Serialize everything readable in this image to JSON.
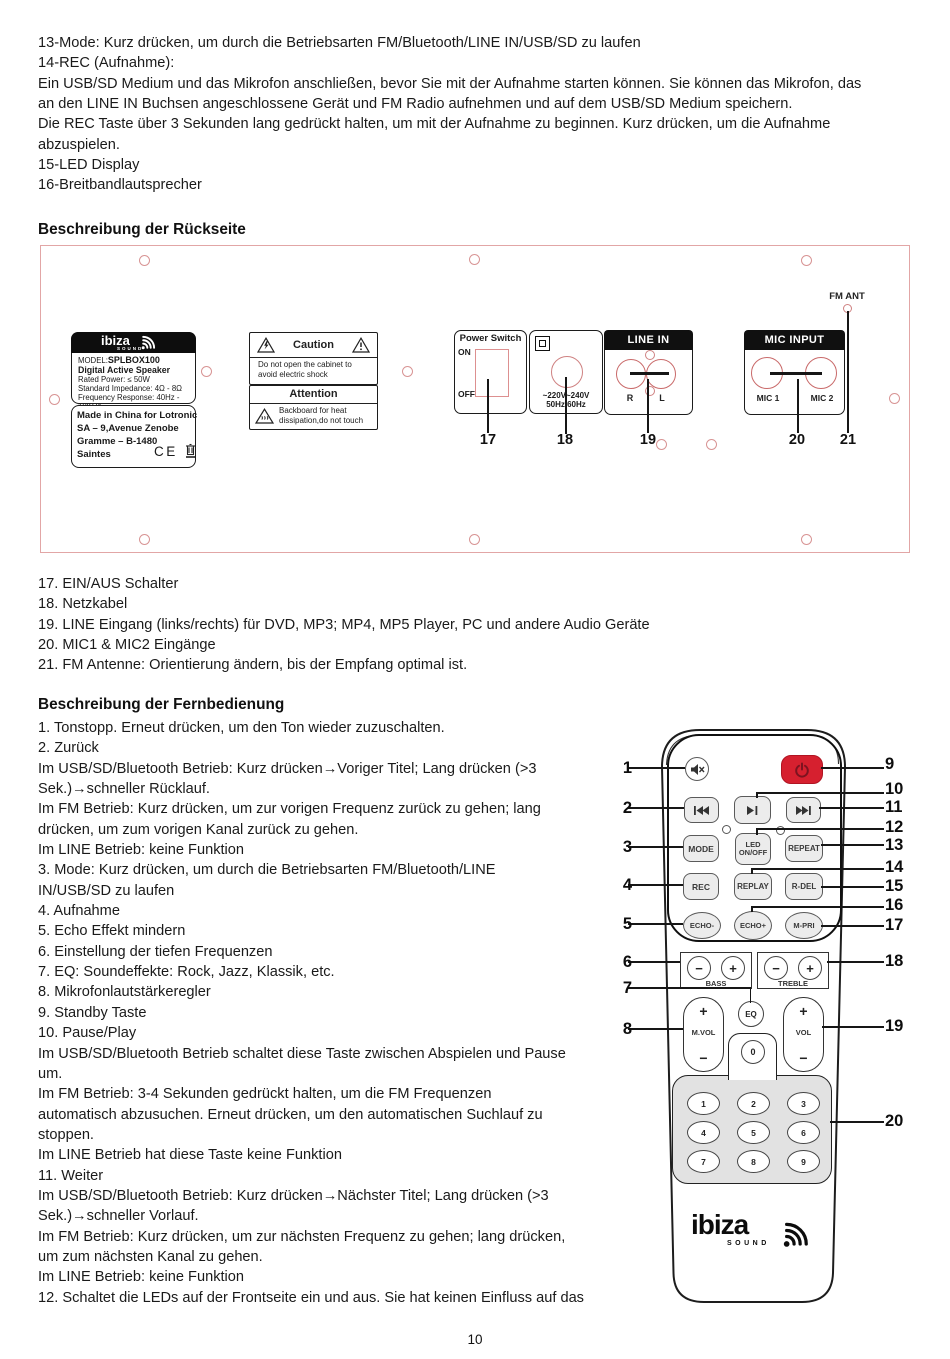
{
  "page_number": "10",
  "intro_lines": [
    "13-Mode: Kurz drücken, um durch die Betriebsarten FM/Bluetooth/LINE IN/USB/SD zu laufen",
    "14-REC (Aufnahme):",
    "Ein USB/SD Medium und das Mikrofon anschließen, bevor Sie mit der Aufnahme starten können. Sie können das Mikrofon, das",
    "an den LINE IN Buchsen angeschlossene Gerät und FM Radio aufnehmen und auf dem USB/SD Medium speichern.",
    "Die REC Taste über 3 Sekunden lang gedrückt halten, um mit der Aufnahme zu beginnen. Kurz drücken, um die Aufnahme",
    "abzuspielen.",
    "15-LED Display",
    "16-Breitbandlautsprecher"
  ],
  "rear": {
    "heading": "Beschreibung der Rückseite",
    "fm_ant": "FM ANT",
    "label_box": {
      "logo": "ibiza",
      "logo_sub": "SOUND",
      "model_prefix": "MODEL:",
      "model": "SPLBOX100",
      "product": "Digital Active Speaker",
      "rated": "Rated Power: ≤ 50W",
      "impedance": "Standard Impedance: 4Ω - 8Ω",
      "frequency": "Frequency Response: 40Hz - 18KHz",
      "made_line1": "Made in China for Lotronic",
      "made_line2": "SA – 9,Avenue Zenobe",
      "made_line3": "Gramme – B-1480",
      "made_line4": "Saintes",
      "ce_mark": "CE"
    },
    "caution": {
      "title": "Caution",
      "body1": "Do not open the cabinet to",
      "body2": "avoid electric shock"
    },
    "attention": {
      "title": "Attention",
      "body1": "Backboard for heat",
      "body2": "dissipation,do not touch"
    },
    "power_switch": {
      "title": "Power Switch",
      "on": "ON",
      "off": "OFF"
    },
    "inlet": {
      "volts": "~220V~240V",
      "hertz": "50Hz/60Hz"
    },
    "line_in": {
      "title": "LINE IN",
      "r": "R",
      "l": "L"
    },
    "mic": {
      "title": "MIC INPUT",
      "mic1": "MIC 1",
      "mic2": "MIC 2"
    },
    "n17": "17",
    "n18": "18",
    "n19": "19",
    "n20": "20",
    "n21": "21"
  },
  "rear_list": [
    "17. EIN/AUS Schalter",
    "18. Netzkabel",
    "19. LINE Eingang (links/rechts) für DVD, MP3; MP4, MP5 Player, PC und andere Audio Geräte",
    "20. MIC1 & MIC2 Eingänge",
    "21. FM Antenne: Orientierung ändern, bis der Empfang optimal ist."
  ],
  "remote_heading": "Beschreibung der Fernbedienung",
  "remote_lines": [
    "1. Tonstopp. Erneut drücken, um den Ton wieder zuzuschalten.",
    "2. Zurück",
    "Im USB/SD/Bluetooth Betrieb: Kurz drücken→Voriger Titel; Lang drücken (>3",
    "Sek.)→schneller Rücklauf.",
    "Im FM Betrieb: Kurz drücken, um zur vorigen Frequenz zurück zu gehen; lang",
    "drücken, um zum vorigen Kanal zurück zu gehen.",
    "Im LINE Betrieb: keine Funktion",
    "3. Mode: Kurz drücken, um durch die Betriebsarten FM/Bluetooth/LINE",
    "IN/USB/SD zu laufen",
    "4. Aufnahme",
    "5. Echo Effekt mindern",
    "6. Einstellung der tiefen Frequenzen",
    "7. EQ: Soundeffekte: Rock, Jazz, Klassik, etc.",
    "8. Mikrofonlautstärkeregler",
    "9. Standby Taste",
    "10. Pause/Play",
    "Im USB/SD/Bluetooth Betrieb schaltet diese Taste zwischen Abspielen und Pause",
    "um.",
    "Im FM Betrieb: 3-4 Sekunden gedrückt halten, um die FM Frequenzen",
    "automatisch abzusuchen. Erneut drücken, um den automatischen Suchlauf zu",
    "stoppen.",
    "Im LINE Betrieb hat diese Taste keine Funktion",
    "11. Weiter",
    "Im USB/SD/Bluetooth Betrieb: Kurz drücken→Nächster Titel; Lang drücken (>3",
    "Sek.)→schneller Vorlauf.",
    "Im FM Betrieb: Kurz drücken, um zur nächsten Frequenz zu gehen; lang drücken,",
    "um zum nächsten Kanal zu gehen.",
    "Im LINE Betrieb: keine Funktion",
    "12. Schaltet die LEDs auf der Frontseite ein und aus. Sie hat keinen Einfluss auf das"
  ],
  "remote": {
    "mode": "MODE",
    "led_line1": "LED",
    "led_line2": "ON/OFF",
    "repeat": "REPEAT",
    "rec": "REC",
    "replay": "REPLAY",
    "rdel": "R-DEL",
    "echo_minus": "ECHO-",
    "echo_plus": "ECHO+",
    "mpri": "M-PRI",
    "bass": "BASS",
    "treble": "TREBLE",
    "eq": "EQ",
    "mvol": "M.VOL",
    "vol": "VOL",
    "plus": "+",
    "minus": "−",
    "zero": "0",
    "digits": [
      "1",
      "2",
      "3",
      "4",
      "5",
      "6",
      "7",
      "8",
      "9"
    ],
    "left_callouts": [
      "1",
      "2",
      "3",
      "4",
      "5",
      "6",
      "7",
      "8"
    ],
    "right_callouts": [
      "9",
      "10",
      "11",
      "12",
      "13",
      "14",
      "15",
      "16",
      "17",
      "18",
      "19",
      "20"
    ],
    "logo": "ibiza",
    "logo_sub": "SOUND",
    "accent_red": "#d6202f"
  }
}
